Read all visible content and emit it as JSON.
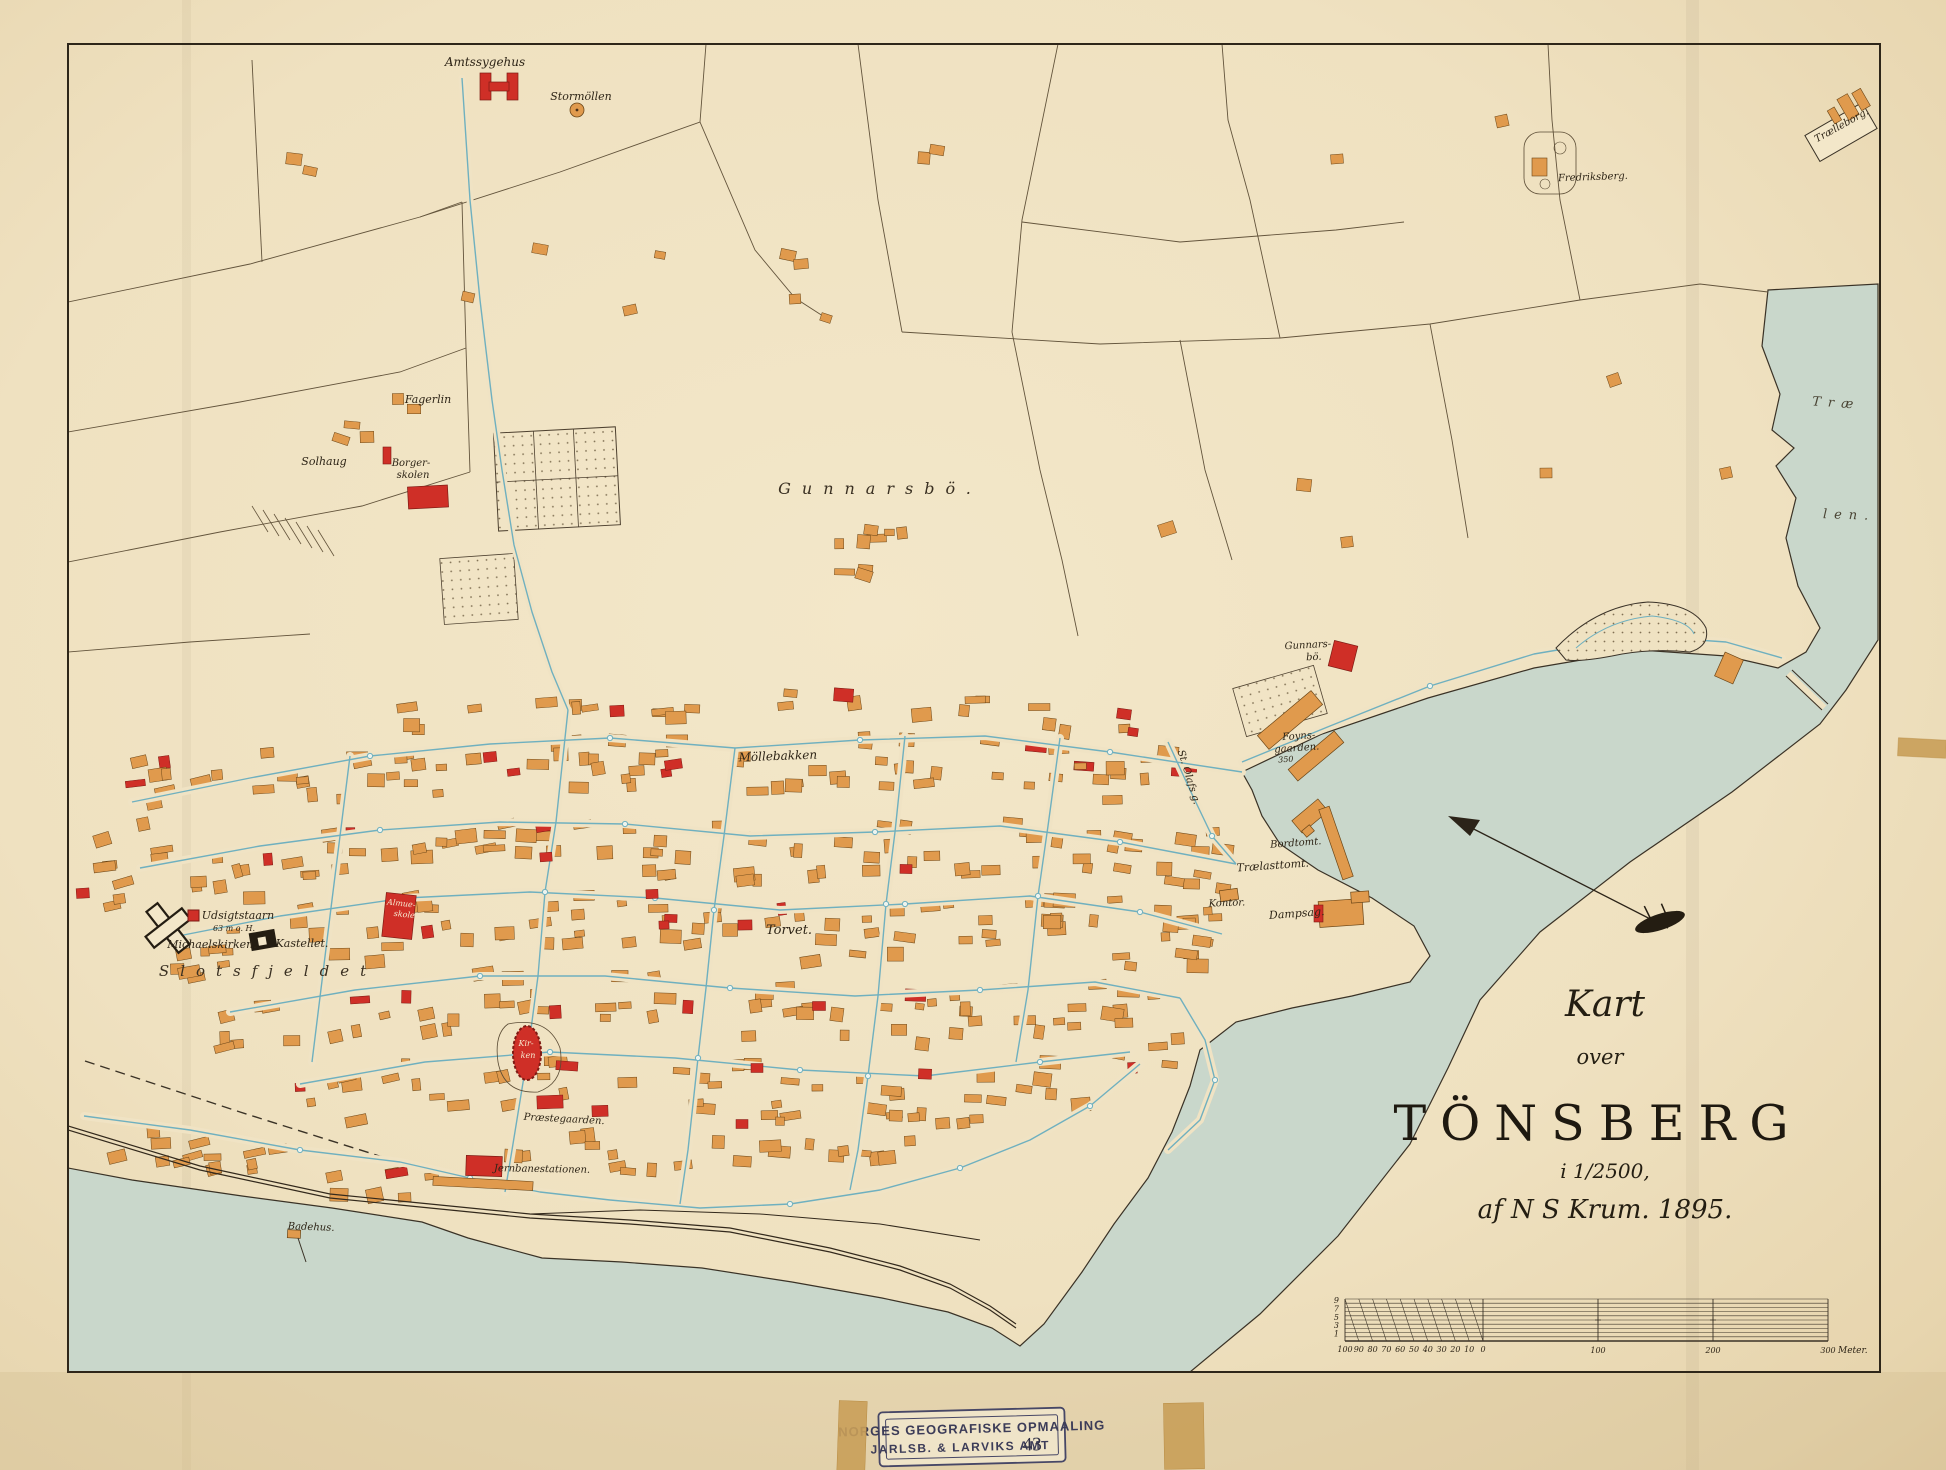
{
  "title_block": {
    "line1": "Kart",
    "line2": "over",
    "city": "TÖNSBERG",
    "scale": "i 1/2500,",
    "author": "af N S Krum. 1895."
  },
  "stamp": {
    "line1": "NORGES GEOGRAFISKE OPMAALING",
    "line2": "JARLSB. & LARVIKS AMT",
    "number": "43"
  },
  "scale_bar": {
    "left_labels": [
      "100",
      "90",
      "80",
      "70",
      "60",
      "50",
      "40",
      "30",
      "20",
      "10",
      "0"
    ],
    "main_labels": [
      "100",
      "200",
      "300"
    ],
    "unit": "Meter.",
    "row_labels": [
      "9",
      "7",
      "5",
      "3",
      "1"
    ]
  },
  "water_labels": [
    {
      "id": "traelen_1",
      "text": "Træ"
    },
    {
      "id": "traelen_2",
      "text": "len."
    }
  ],
  "place_labels": [
    {
      "id": "amtssygehus",
      "text": "Amtssygehus"
    },
    {
      "id": "stormollen",
      "text": "Stormöllen"
    },
    {
      "id": "fagerlin",
      "text": "Fagerlin"
    },
    {
      "id": "solhaug",
      "text": "Solhaug"
    },
    {
      "id": "borgerskolen_1",
      "text": "Borger-"
    },
    {
      "id": "borgerskolen_2",
      "text": "skolen"
    },
    {
      "id": "gunnarsbo_area",
      "text": "Gunnarsbö."
    },
    {
      "id": "gunnarsbo_farm_1",
      "text": "Gunnars-"
    },
    {
      "id": "gunnarsbo_farm_2",
      "text": "bö."
    },
    {
      "id": "mollebakken",
      "text": "Möllebakken"
    },
    {
      "id": "torvet",
      "text": "Torvet."
    },
    {
      "id": "udsigtstaarn",
      "text": "Udsigtstaarn"
    },
    {
      "id": "udsigt_height",
      "text": "63 m o. H."
    },
    {
      "id": "michaelskirken",
      "text": "Michaelskirken."
    },
    {
      "id": "kastellet",
      "text": "Kastellet."
    },
    {
      "id": "slotsfjeldet",
      "text": "Slotsfjeldet"
    },
    {
      "id": "almueskole_1",
      "text": "Almue-"
    },
    {
      "id": "almueskole_2",
      "text": "skole"
    },
    {
      "id": "kirken_1",
      "text": "Kir-"
    },
    {
      "id": "kirken_2",
      "text": "ken"
    },
    {
      "id": "jernbanestationen",
      "text": "Jernbanestationen."
    },
    {
      "id": "badehus",
      "text": "Badehus."
    },
    {
      "id": "praestegaarden",
      "text": "Præstegaarden."
    },
    {
      "id": "foynsgaarden_1",
      "text": "Foyns-"
    },
    {
      "id": "foynsgaarden_2",
      "text": "gaarden."
    },
    {
      "id": "foynsgaarden_nr",
      "text": "350"
    },
    {
      "id": "st_olafs_gade",
      "text": "St. Olafs g."
    },
    {
      "id": "bordtomt",
      "text": "Bordtomt."
    },
    {
      "id": "traelasttomt",
      "text": "Trælasttomt."
    },
    {
      "id": "kontor",
      "text": "Kontor."
    },
    {
      "id": "dampsag",
      "text": "Dampsag."
    },
    {
      "id": "fredriksberg",
      "text": "Fredriksberg."
    },
    {
      "id": "traelleborg",
      "text": "Trælleborg."
    }
  ],
  "colors": {
    "paper": "#f0e3c4",
    "water": "#c9d7cb",
    "building": "#e09a4d",
    "public_building": "#cf2f27",
    "water_pipe": "#6fb0bf",
    "ink": "#3a3226"
  }
}
